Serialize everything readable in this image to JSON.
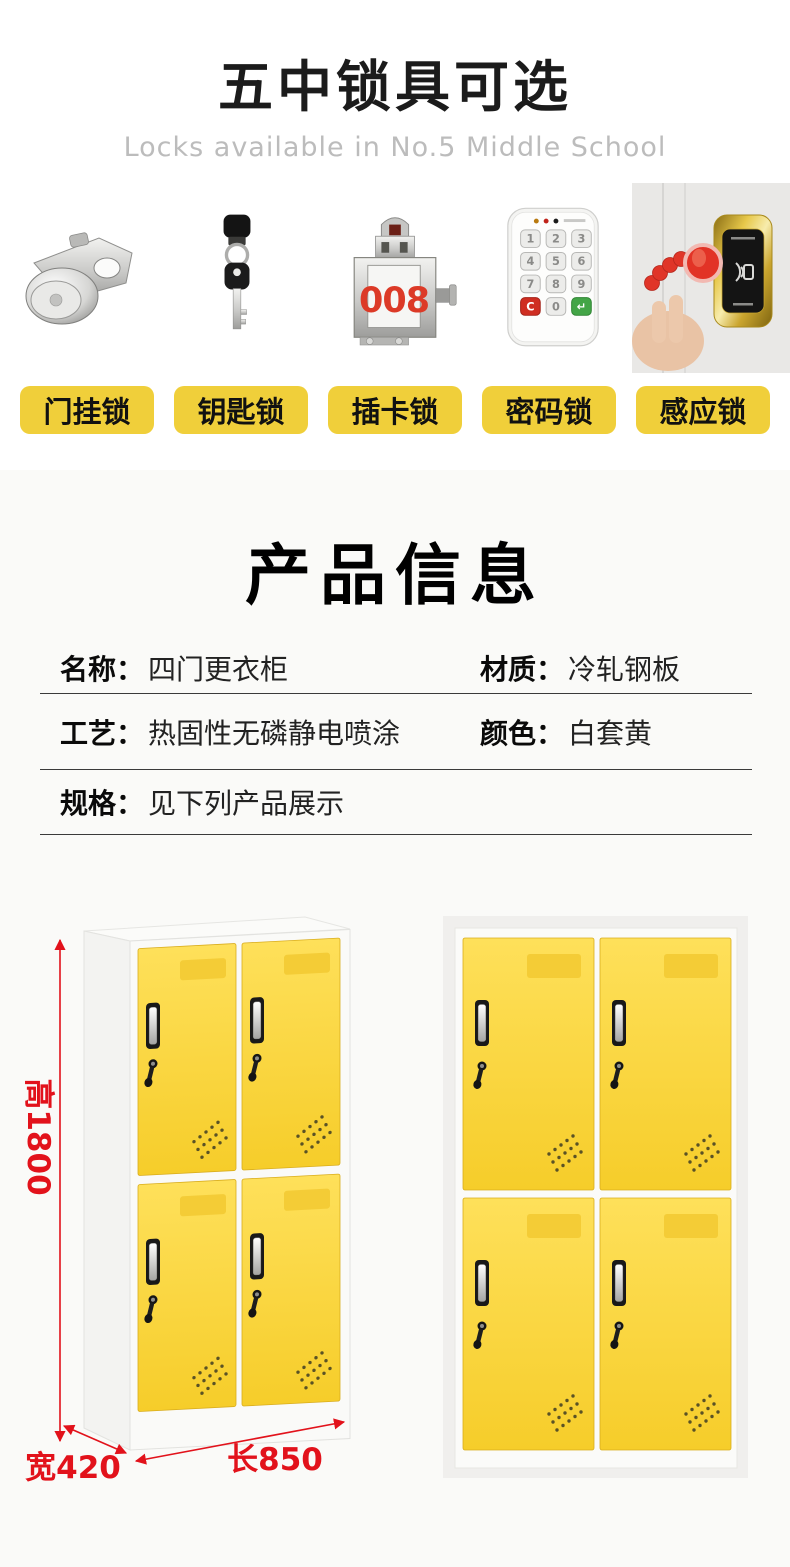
{
  "header": {
    "title": "五中锁具可选",
    "subtitle": "Locks available in No.5 Middle School"
  },
  "locks": {
    "items": [
      {
        "name": "cam-lock",
        "label": "门挂锁"
      },
      {
        "name": "key-lock",
        "label": "钥匙锁"
      },
      {
        "name": "card-lock",
        "label": "插卡锁",
        "plate_number": "008"
      },
      {
        "name": "keypad-lock",
        "label": "密码锁",
        "keys": [
          "1",
          "2",
          "3",
          "4",
          "5",
          "6",
          "7",
          "8",
          "9",
          "C",
          "0",
          "↵"
        ]
      },
      {
        "name": "induction-lock",
        "label": "感应锁"
      }
    ]
  },
  "product_info": {
    "title": "产品信息",
    "rows": [
      {
        "cells": [
          {
            "label": "名称：",
            "value": "四门更衣柜"
          },
          {
            "label": "材质：",
            "value": "冷轧钢板"
          }
        ]
      },
      {
        "cells": [
          {
            "label": "工艺：",
            "value": "热固性无磷静电喷涂"
          },
          {
            "label": "颜色：",
            "value": "白套黄"
          }
        ]
      },
      {
        "cells": [
          {
            "label": "规格：",
            "value": "见下列产品展示"
          }
        ]
      }
    ]
  },
  "lockers": {
    "height_label": "高1800",
    "width_label": "宽420",
    "length_label": "长850"
  },
  "colors": {
    "label_yellow": "#f0cf3a",
    "door_yellow": "#f8d02e",
    "dimension_red": "#e2121b",
    "plate_number_red": "#dc3a27",
    "section_bg": "#fafaf8"
  }
}
